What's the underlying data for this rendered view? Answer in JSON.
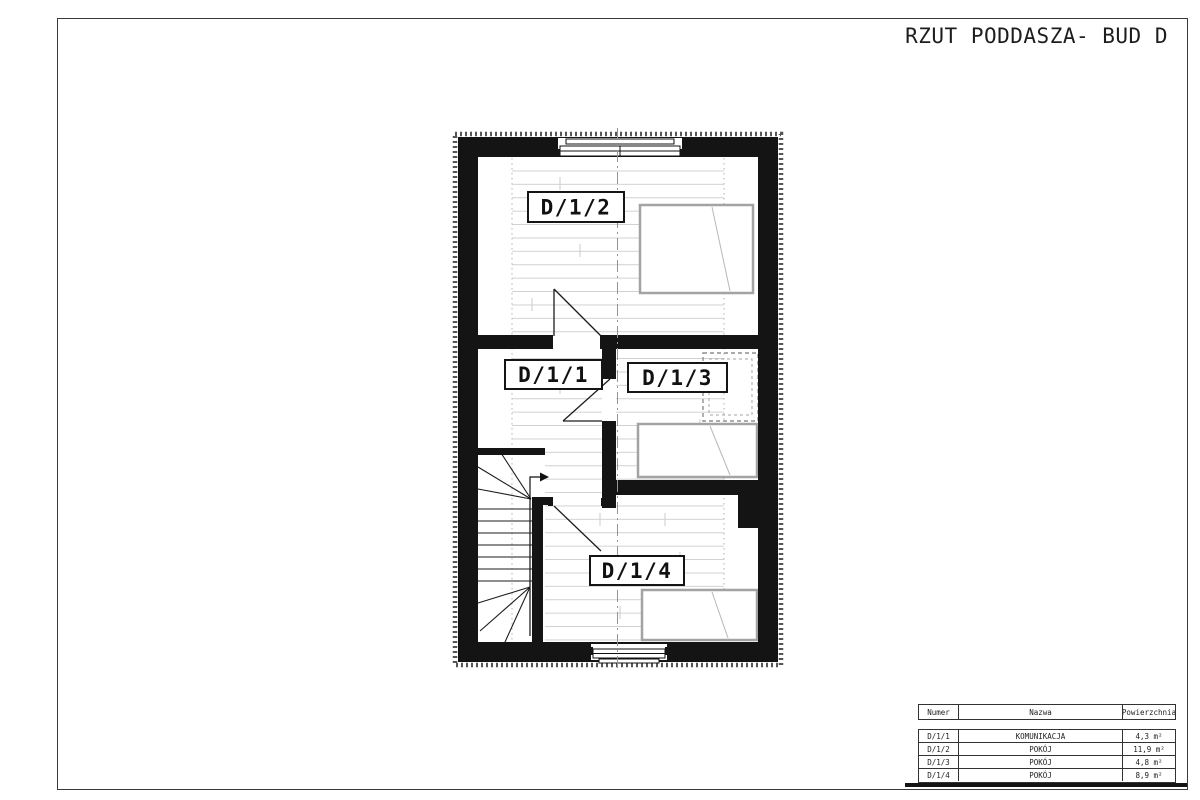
{
  "page": {
    "title": "RZUT PODDASZA- BUD D"
  },
  "plan": {
    "labels": {
      "d11": "D/1/1",
      "d12": "D/1/2",
      "d13": "D/1/3",
      "d14": "D/1/4"
    }
  },
  "legend_table": {
    "headers": {
      "numer": "Numer",
      "nazwa": "Nazwa",
      "powierzchnia": "Powierzchnia"
    },
    "rows": [
      {
        "numer": "D/1/1",
        "nazwa": "KOMUNIKACJA",
        "area": "4,3 m²"
      },
      {
        "numer": "D/1/2",
        "nazwa": "POKÓJ",
        "area": "11,9 m²"
      },
      {
        "numer": "D/1/3",
        "nazwa": "POKÓJ",
        "area": "4,8 m²"
      },
      {
        "numer": "D/1/4",
        "nazwa": "POKÓJ",
        "area": "8,9 m²"
      }
    ]
  },
  "colors": {
    "wall": "#141414",
    "furniture_outline": "#a3a3a3",
    "floor_plank_line": "#cbcbcb",
    "centerline": "#949494"
  }
}
